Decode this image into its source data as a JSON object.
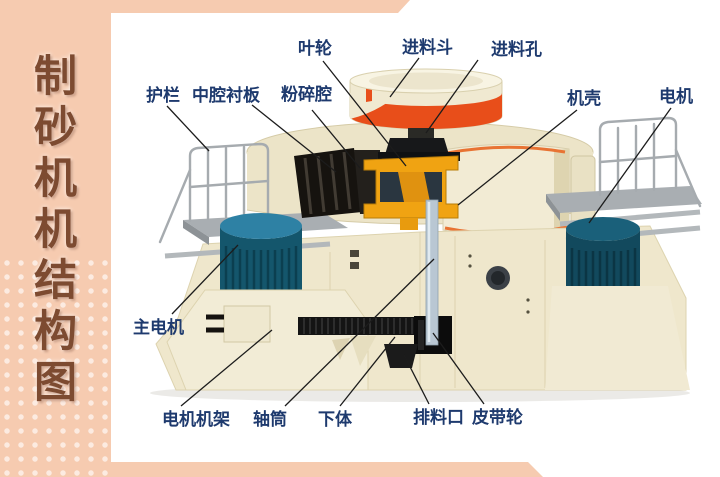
{
  "page": {
    "background": "#ffffff",
    "accent_peach": "#f6cbb0",
    "title_color": "#7d4b31",
    "label_color": "#1e3a6e"
  },
  "sidebar": {
    "title": "制砂机机结构图",
    "title_chars": [
      "制",
      "砂",
      "机",
      "机",
      "结",
      "构",
      "图"
    ]
  },
  "diagram": {
    "labels": {
      "impeller": "叶轮",
      "feed_hopper": "进料斗",
      "feed_hole": "进料孔",
      "guardrail": "护栏",
      "cavity_liner": "中腔衬板",
      "crushing_chamber": "粉碎腔",
      "casing": "机壳",
      "motor": "电机",
      "main_motor": "主电机",
      "motor_frame": "电机机架",
      "shaft_tube": "轴筒",
      "lower_body": "下体",
      "discharge_port": "排料口",
      "belt_pulley": "皮带轮"
    },
    "machine_colors": {
      "body_cream": "#efe7cc",
      "hopper_band_red": "#e84e1a",
      "impeller_orange": "#f0a312",
      "motor_teal": "#14566c",
      "platform_grey": "#a9aeb2"
    }
  }
}
